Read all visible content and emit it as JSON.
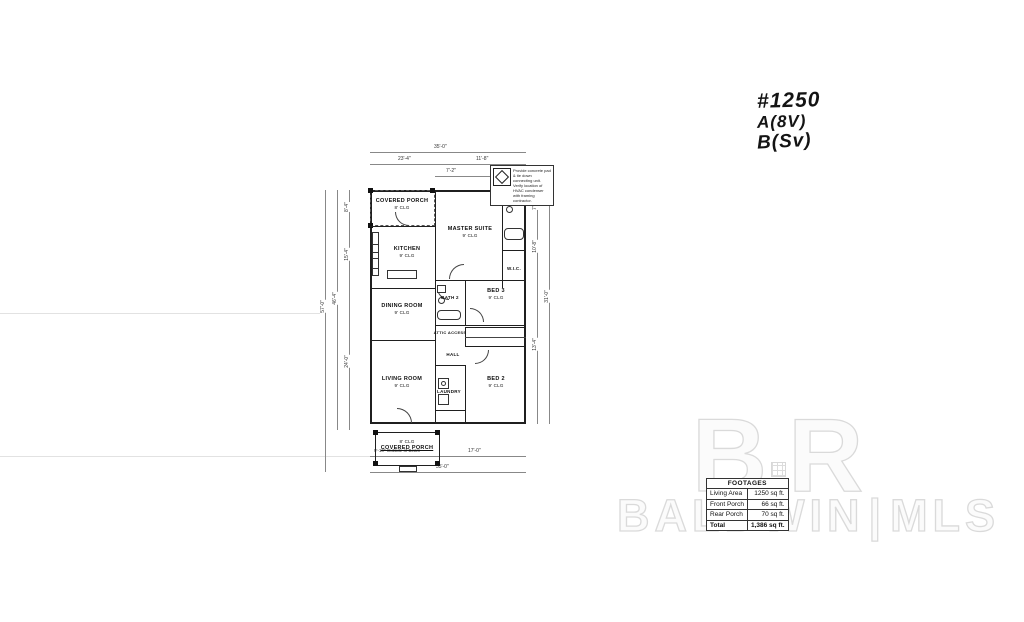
{
  "annotations": {
    "plan_number": "#1250",
    "note_a": "A(8V)",
    "note_b": "B(Sv)",
    "hvac_note": "Provide concrete pad & tie down connecting unit. Verify location of HVAC condenser with framing contractor."
  },
  "plan": {
    "rooms": [
      {
        "name": "COVERED PORCH",
        "ceiling": "8' CLG"
      },
      {
        "name": "MASTER SUITE",
        "ceiling": "9' CLG"
      },
      {
        "name": "M.BATH",
        "ceiling": ""
      },
      {
        "name": "W.I.C.",
        "ceiling": ""
      },
      {
        "name": "KITCHEN",
        "ceiling": "9' CLG"
      },
      {
        "name": "DINING ROOM",
        "ceiling": "9' CLG"
      },
      {
        "name": "BATH 2",
        "ceiling": ""
      },
      {
        "name": "BED 3",
        "ceiling": "9' CLG"
      },
      {
        "name": "ATTIC ACCESS",
        "ceiling": ""
      },
      {
        "name": "HALL",
        "ceiling": ""
      },
      {
        "name": "LIVING ROOM",
        "ceiling": "9' CLG"
      },
      {
        "name": "LAUNDRY",
        "ceiling": ""
      },
      {
        "name": "BED 2",
        "ceiling": "9' CLG"
      },
      {
        "name": "COVERED PORCH",
        "ceiling": "8' CLG"
      }
    ],
    "dimensions": {
      "top": [
        "35'-0\"",
        "23'-4\"",
        "11'-8\"",
        "7'-2\"",
        "2'-0\""
      ],
      "left": [
        "57'-0\"",
        "46'-4\"",
        "8'-4\"",
        "15'-4\"",
        "24'-0\""
      ],
      "right": [
        "7'-6\"",
        "10'-8\"",
        "13'-4\"",
        "31'-0\""
      ],
      "bottom": [
        "9'-10\" Outside of Beam",
        "17'-0\"",
        "35'-0\""
      ]
    }
  },
  "footages": {
    "header": "FOOTAGES",
    "rows": [
      {
        "label": "Living Area",
        "value": "1250 sq ft."
      },
      {
        "label": "Front Porch",
        "value": "66 sq ft."
      },
      {
        "label": "Rear Porch",
        "value": "70 sq ft."
      },
      {
        "label": "Total",
        "value": "1,386 sq ft."
      }
    ]
  },
  "watermark": {
    "logo_b": "B",
    "logo_r": "R",
    "brand": "BALDWIN",
    "divider": "|",
    "suffix": "MLS"
  }
}
